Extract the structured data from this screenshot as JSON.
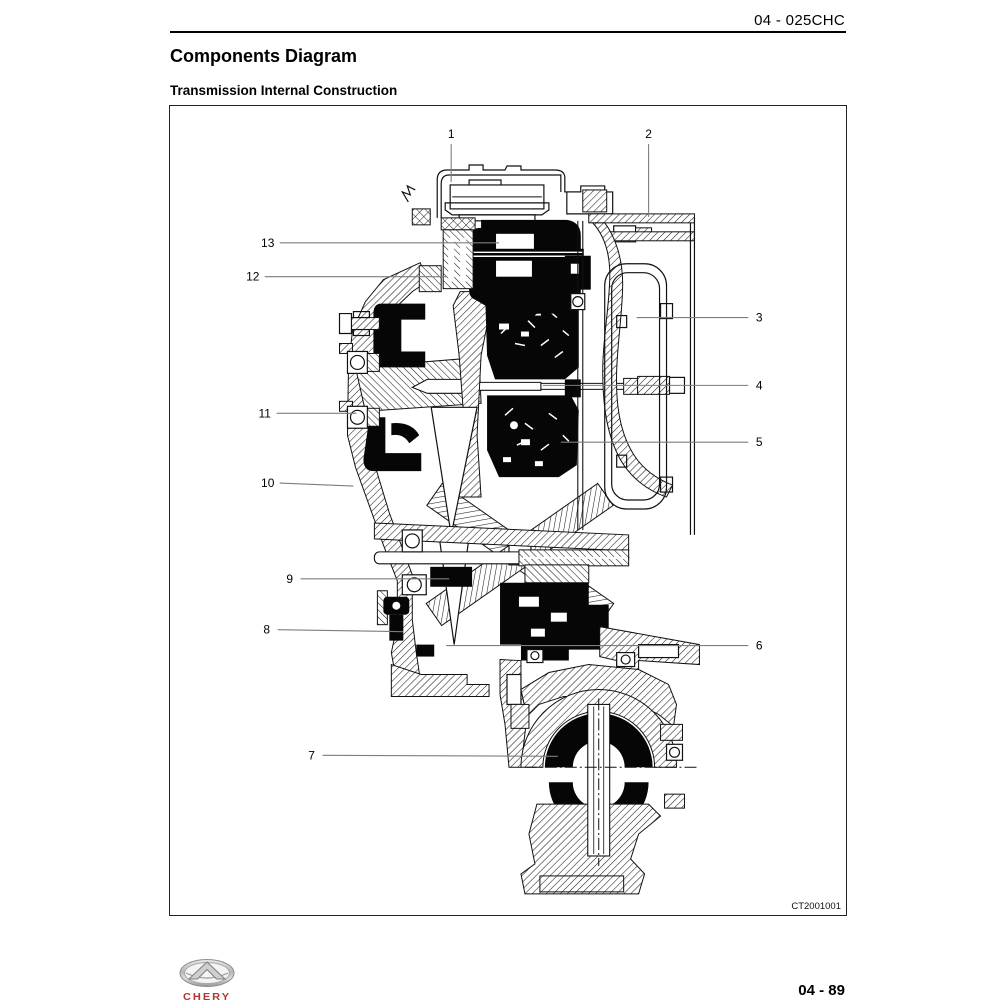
{
  "page": {
    "header_code": "04 - 025CHC",
    "title": "Components Diagram",
    "subtitle": "Transmission Internal Construction",
    "figure_code": "CT2001001",
    "page_number": "04 - 89",
    "brand_name": "CHERY",
    "accent_red": "#b5342e"
  },
  "figure": {
    "type": "technical-illustration",
    "subject": "Automatic transmission internal construction, sectional view",
    "callouts": [
      {
        "label": "1",
        "label_x": 282,
        "label_y": 28,
        "x1": 282,
        "y1": 38,
        "x2": 282,
        "y2": 76
      },
      {
        "label": "2",
        "label_x": 480,
        "label_y": 28,
        "x1": 480,
        "y1": 38,
        "x2": 480,
        "y2": 111
      },
      {
        "label": "13",
        "label_x": 98,
        "label_y": 137,
        "x1": 110,
        "y1": 137,
        "x2": 330,
        "y2": 137
      },
      {
        "label": "12",
        "label_x": 83,
        "label_y": 171,
        "x1": 95,
        "y1": 171,
        "x2": 277,
        "y2": 171
      },
      {
        "label": "3",
        "label_x": 591,
        "label_y": 212,
        "x1": 468,
        "y1": 212,
        "x2": 580,
        "y2": 212
      },
      {
        "label": "4",
        "label_x": 591,
        "label_y": 280,
        "x1": 374,
        "y1": 280,
        "x2": 580,
        "y2": 280
      },
      {
        "label": "11",
        "label_x": 95,
        "label_y": 308,
        "x1": 107,
        "y1": 308,
        "x2": 187,
        "y2": 308
      },
      {
        "label": "5",
        "label_x": 591,
        "label_y": 337,
        "x1": 392,
        "y1": 337,
        "x2": 580,
        "y2": 337
      },
      {
        "label": "10",
        "label_x": 98,
        "label_y": 378,
        "x1": 110,
        "y1": 378,
        "x2": 184,
        "y2": 381
      },
      {
        "label": "9",
        "label_x": 120,
        "label_y": 474,
        "x1": 131,
        "y1": 474,
        "x2": 280,
        "y2": 474
      },
      {
        "label": "8",
        "label_x": 97,
        "label_y": 525,
        "x1": 108,
        "y1": 525,
        "x2": 234,
        "y2": 527
      },
      {
        "label": "6",
        "label_x": 591,
        "label_y": 541,
        "x1": 277,
        "y1": 541,
        "x2": 580,
        "y2": 541
      },
      {
        "label": "7",
        "label_x": 142,
        "label_y": 651,
        "x1": 153,
        "y1": 651,
        "x2": 389,
        "y2": 652
      }
    ]
  }
}
